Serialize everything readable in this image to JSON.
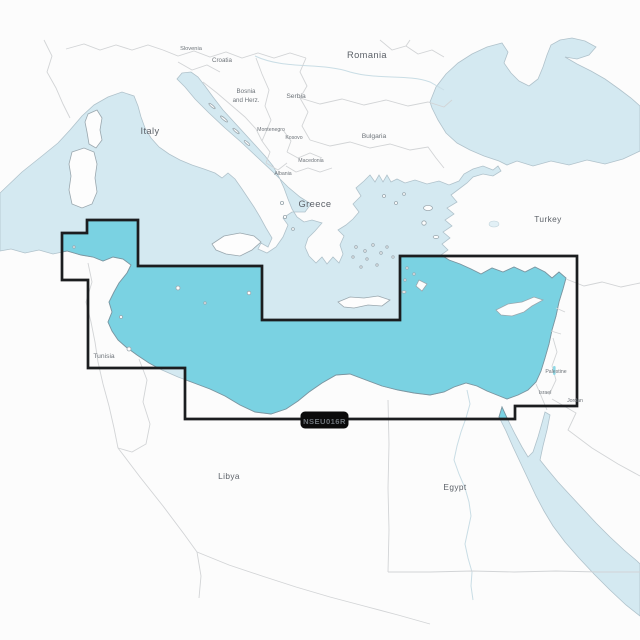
{
  "badge": {
    "code": "NSEU016R"
  },
  "colors": {
    "coverage_fill": "#7AD2E2",
    "coverage_outline": "#1B1D1F",
    "sea": "#D4E9F1",
    "land": "#FCFCFC",
    "badge_bg": "#0B0B0B",
    "badge_text": "#FFFFFF"
  },
  "map": {
    "labels": {
      "italy": "Italy",
      "slovenia": "Slovenia",
      "croatia": "Croatia",
      "bosnia_1": "Bosnia",
      "bosnia_2": "and Herz.",
      "serbia": "Serbia",
      "montenegro": "Montenegro",
      "kosovo": "Kosovo",
      "macedonia": "Macedonia",
      "albania": "Albania",
      "romania": "Romania",
      "bulgaria": "Bulgaria",
      "greece": "Greece",
      "turkey": "Turkey",
      "tunisia": "Tunisia",
      "libya": "Libya",
      "egypt": "Egypt",
      "palestine": "Palestine",
      "israel": "Israel",
      "jordan": "Jordan"
    }
  }
}
